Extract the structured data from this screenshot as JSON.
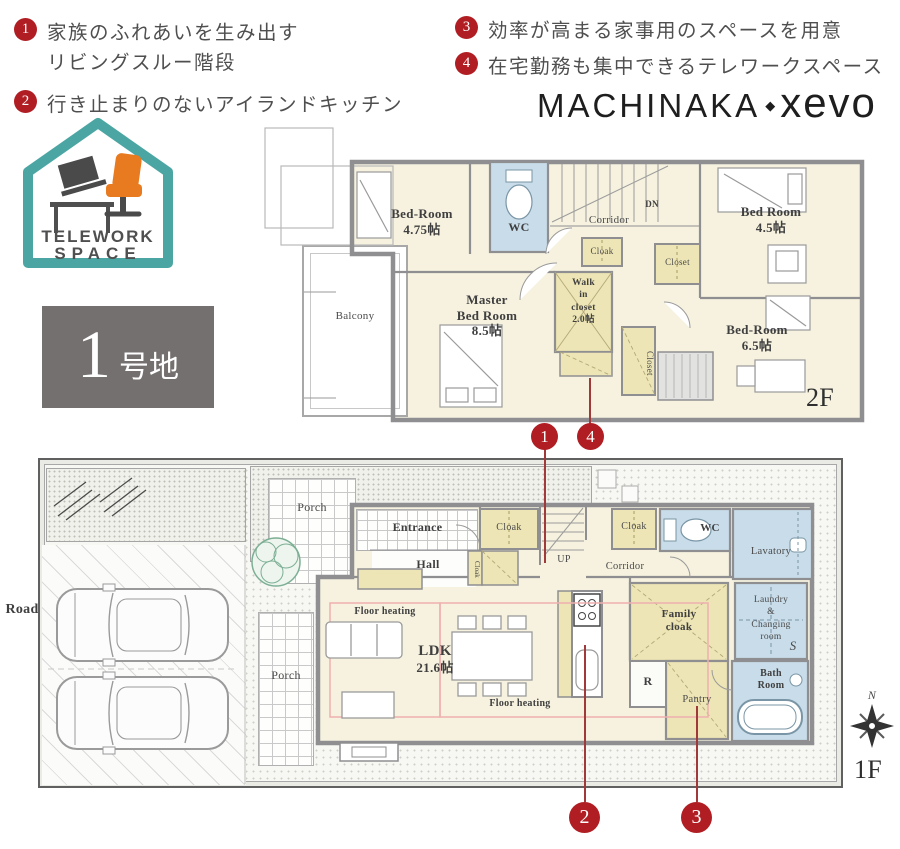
{
  "features": [
    {
      "num": "1",
      "line1": "家族のふれあいを生み出す",
      "line2": "リビングスルー階段"
    },
    {
      "num": "2",
      "line1": "行き止まりのないアイランドキッチン",
      "line2": ""
    },
    {
      "num": "3",
      "line1": "効率が高まる家事用のスペースを用意",
      "line2": ""
    },
    {
      "num": "4",
      "line1": "在宅勤務も集中できるテレワークスペース",
      "line2": ""
    }
  ],
  "brand": {
    "name_left": "MACHINAKA",
    "separator": "◆",
    "name_right": "xevo"
  },
  "badge": {
    "line1": "TELEWORK",
    "line2": "SPACE"
  },
  "lot": {
    "number": "1",
    "suffix": "号地"
  },
  "floor2": {
    "label": "2F",
    "rooms": {
      "bed1_name": "Bed-Room",
      "bed1_size": "4.75帖",
      "wc": "WC",
      "corridor": "Corridor",
      "dn": "DN",
      "bed2_name": "Bed Room",
      "bed2_size": "4.5帖",
      "cloak": "Cloak",
      "closet1": "Closet",
      "wic_l1": "Walk",
      "wic_l2": "in",
      "wic_l3": "closet",
      "wic_l4": "2.0帖",
      "master_l1": "Master",
      "master_l2": "Bed Room",
      "master_l3": "8.5帖",
      "closet2": "Closet",
      "bed3_name": "Bed-Room",
      "bed3_size": "6.5帖",
      "balcony": "Balcony"
    }
  },
  "floor1": {
    "label": "1F",
    "road": "Road",
    "compass_n": "N",
    "rooms": {
      "porch_top": "Porch",
      "porch_left": "Porch",
      "entrance": "Entrance",
      "hall": "Hall",
      "cloak1": "Cloak",
      "cloak2": "Cloak",
      "cloak3": "Cloak",
      "up": "UP",
      "corridor": "Corridor",
      "wc": "WC",
      "lavatory": "Lavatory",
      "laundry_l1": "Laundry",
      "laundry_l2": "&",
      "laundry_l3": "Changing",
      "laundry_l4": "room",
      "s": "S",
      "family_l1": "Family",
      "family_l2": "cloak",
      "bath_l1": "Bath",
      "bath_l2": "Room",
      "r": "R",
      "pantry": "Pantry",
      "ldk_name": "LDK",
      "ldk_size": "21.6帖",
      "floor_heating": "Floor heating"
    }
  },
  "markers": {
    "m1": "1",
    "m2": "2",
    "m3": "3",
    "m4": "4"
  },
  "colors": {
    "accent_red": "#B01E23",
    "badge_teal": "#4BA6A3",
    "chair_orange": "#E87A1F",
    "wall_gray": "#8F8F92",
    "room_cream": "#F6F2DF",
    "closet_yellow": "#EDE5B5",
    "wet_blue": "#C8DCE9",
    "lot_gray": "#757070",
    "heating_pink": "#EFAFAF"
  }
}
